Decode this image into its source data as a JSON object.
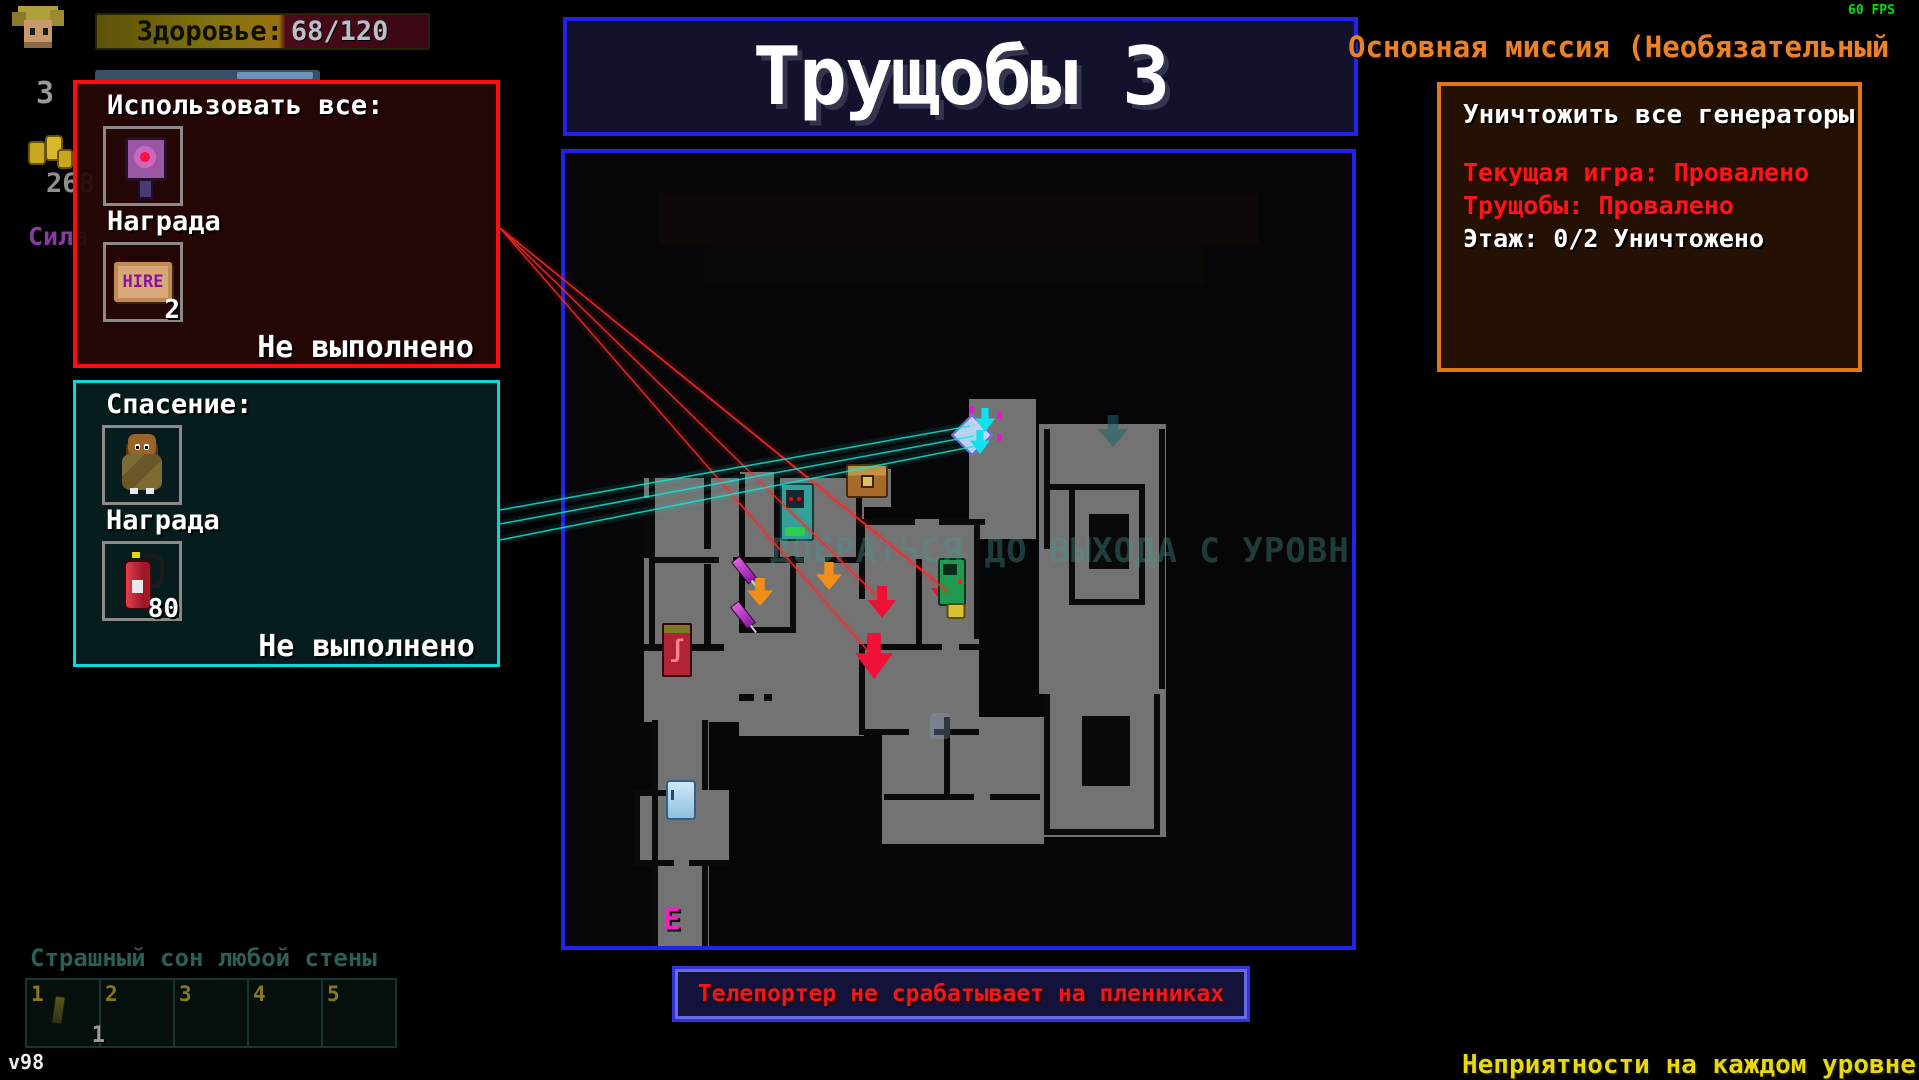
{
  "hud": {
    "fps": "60 FPS",
    "version": "v98",
    "health": {
      "label": "Здоровье:",
      "value": "68/120"
    },
    "level": "3",
    "money": "268",
    "stat_label": "Сила",
    "class_name": "Страшный сон любой стены",
    "warning_bottom_right": "Неприятности на каждом уровне",
    "inventory": {
      "slot_numbers": [
        "1",
        "2",
        "3",
        "4",
        "5"
      ],
      "slot1_count": "1"
    }
  },
  "level_title": "Трущобы 3",
  "map": {
    "watermark": "ДОБРАТЬСЯ ДО ВЫХОДА С УРОВНЯ",
    "exit_letter": "E",
    "markers": [
      {
        "type": "chest",
        "x": 302,
        "y": 328
      },
      {
        "type": "vendor_teal",
        "x": 232,
        "y": 359
      },
      {
        "type": "vendor_red",
        "x": 112,
        "y": 497
      },
      {
        "type": "syringe",
        "x": 179,
        "y": 417
      },
      {
        "type": "syringe",
        "x": 178,
        "y": 462
      },
      {
        "type": "arrow_orange",
        "x": 195,
        "y": 439
      },
      {
        "type": "arrow_orange",
        "x": 264,
        "y": 423
      },
      {
        "type": "arrow_red",
        "x": 317,
        "y": 449
      },
      {
        "type": "arrow_red",
        "x": 380,
        "y": 437
      },
      {
        "type": "arrow_red_big",
        "x": 309,
        "y": 503
      },
      {
        "type": "slot_machine",
        "x": 387,
        "y": 429
      },
      {
        "type": "item_yellow",
        "x": 391,
        "y": 458
      },
      {
        "type": "exit_marker",
        "x": 416,
        "y": 281
      },
      {
        "type": "arrow_teal",
        "x": 548,
        "y": 278
      },
      {
        "type": "fridge",
        "x": 116,
        "y": 647
      },
      {
        "type": "npc",
        "x": 375,
        "y": 573
      },
      {
        "type": "exit_letter",
        "x": 107,
        "y": 767
      }
    ]
  },
  "toast": "Телепортер не срабатывает на пленниках",
  "mission_header": "Основная миссия (Необязательный",
  "mission_panel": {
    "objective": "Уничтожить все генераторы",
    "status_lines": [
      {
        "text": "Текущая игра: Провалено",
        "color": "red"
      },
      {
        "text": "Трущобы: Провалено",
        "color": "red"
      },
      {
        "text": "Этаж: 0/2 Уничтожено",
        "color": "white"
      }
    ]
  },
  "quests": [
    {
      "title": "Использовать все:",
      "reward_label": "Награда",
      "reward_count": "2",
      "hire_text": "HIRE",
      "status": "Не выполнено"
    },
    {
      "title": "Спасение:",
      "reward_label": "Награда",
      "reward_count": "80",
      "status": "Не выполнено"
    }
  ],
  "colors": {
    "accent_blue": "#2222ee",
    "accent_red": "#ff0d0d",
    "accent_cyan": "#00dcdc",
    "accent_orange": "#e07818",
    "laser_red": "#ff2020",
    "laser_cyan": "#00e0d0",
    "text_yellow": "#e8d810",
    "text_green": "#00e010",
    "watermark_teal": "#4a9691"
  }
}
